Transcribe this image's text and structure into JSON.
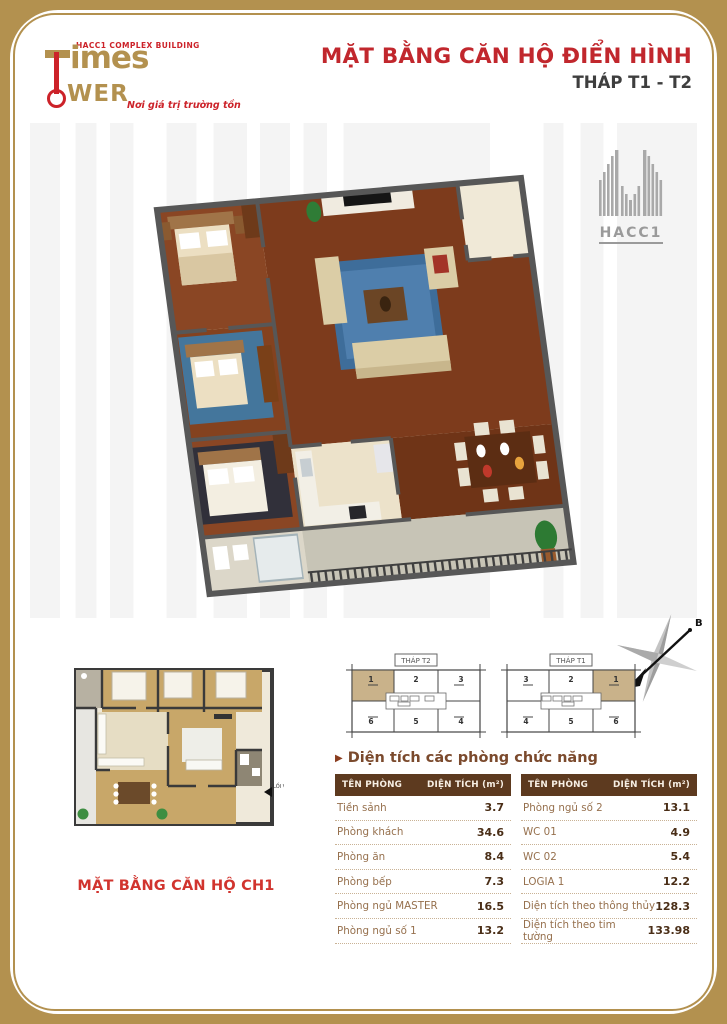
{
  "brand": {
    "building_label": "HACC1 COMPLEX BUILDING",
    "wordmark_top": "imes",
    "wordmark_bottom": "WER",
    "tagline": "Nơi giá trị trường tồn"
  },
  "header": {
    "title": "MẶT BẰNG CĂN HỘ ĐIỂN HÌNH",
    "subtitle": "THÁP T1 - T2"
  },
  "watermark": {
    "label": "HACC1"
  },
  "plan2d": {
    "caption": "MẶT BẰNG CĂN HỘ CH1",
    "entrance_label": "LỐI VÀO"
  },
  "compass": {
    "north_label": "B"
  },
  "keyplans": [
    {
      "label": "THÁP T2",
      "cells": [
        "1",
        "2",
        "3",
        "6",
        "5",
        "4"
      ]
    },
    {
      "label": "THÁP T1",
      "cells": [
        "3",
        "2",
        "1",
        "4",
        "5",
        "6"
      ]
    }
  ],
  "area_section": {
    "title": "Diện tích các phòng chức năng",
    "arrow": "▶",
    "col_room": "TÊN PHÒNG",
    "col_area": "DIỆN TÍCH (m²)",
    "left_rows": [
      {
        "name": "Tiền sảnh",
        "value": "3.7"
      },
      {
        "name": "Phòng khách",
        "value": "34.6"
      },
      {
        "name": "Phòng ăn",
        "value": "8.4"
      },
      {
        "name": "Phòng bếp",
        "value": "7.3"
      },
      {
        "name": "Phòng ngủ MASTER",
        "value": "16.5"
      },
      {
        "name": "Phòng ngủ số 1",
        "value": "13.2"
      }
    ],
    "right_rows": [
      {
        "name": "Phòng ngủ số 2",
        "value": "13.1"
      },
      {
        "name": "WC 01",
        "value": "4.9"
      },
      {
        "name": "WC 02",
        "value": "5.4"
      },
      {
        "name": "LOGIA 1",
        "value": "12.2"
      },
      {
        "name": "Diện tích theo thông thủy",
        "value": "128.3"
      },
      {
        "name": "Diện tích theo tim tường",
        "value": "133.98"
      }
    ]
  },
  "colors": {
    "accent_red": "#C1272D",
    "frame_gold": "#B3914F",
    "table_header_brown": "#5D3A1F",
    "table_text_brown": "#96704D",
    "highlight_tan": "#C9B28A",
    "wall_gray": "#575757"
  }
}
